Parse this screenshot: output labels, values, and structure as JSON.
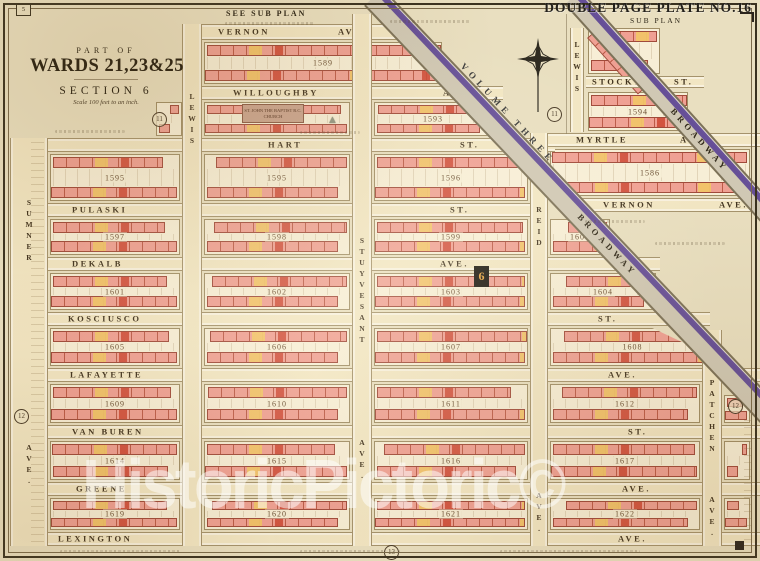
{
  "page": {
    "plate_label": "DOUBLE PAGE PLATE NO.16",
    "see_sub_plan": "SEE SUB PLAN",
    "sub_plan": "SUB PLAN",
    "volume_label": "VOLUME THREE",
    "watermark": "HistoricPictoric©",
    "corner_mark": "5",
    "section_marker": "6",
    "church_label": "ST. JOHN THE BAPTIST R.C. CHURCH",
    "triangle_symbol": "▲"
  },
  "title": {
    "part_of": "PART OF",
    "wards": "WARDS 21,23&25",
    "section": "SECTION 6",
    "scale": "Scale 100 feet to an inch."
  },
  "colors": {
    "paper": "#e9dfc0",
    "block_fill": "#f7eed6",
    "building_pink": "#efa093",
    "building_red": "#cd4632",
    "building_yellow": "#f2c468",
    "street_fill": "#f2e6c3",
    "broadway_purple": "#5a4194",
    "ink": "#41331f"
  },
  "streets": {
    "horizontal": [
      {
        "name": "vernon-ave-west",
        "x": 188,
        "y": 24,
        "w": 230,
        "h": 16,
        "labels": [
          {
            "t": "VERNON",
            "x": 30
          },
          {
            "t": "AVE.",
            "x": 150
          }
        ]
      },
      {
        "name": "willoughby-ave",
        "x": 185,
        "y": 86,
        "w": 318,
        "h": 14,
        "labels": [
          {
            "t": "WILLOUGHBY",
            "x": 48
          },
          {
            "t": "AVE.",
            "x": 258
          }
        ]
      },
      {
        "name": "hart-st",
        "x": 10,
        "y": 138,
        "w": 545,
        "h": 14,
        "labels": [
          {
            "t": "HART",
            "x": 258
          },
          {
            "t": "ST.",
            "x": 450
          }
        ]
      },
      {
        "name": "pulaski-st",
        "x": 10,
        "y": 203,
        "w": 522,
        "h": 14,
        "labels": [
          {
            "t": "PULASKI",
            "x": 62
          },
          {
            "t": "ST.",
            "x": 440
          }
        ]
      },
      {
        "name": "dekalb-ave",
        "x": 10,
        "y": 257,
        "w": 650,
        "h": 14,
        "labels": [
          {
            "t": "DEKALB",
            "x": 62
          },
          {
            "t": "AVE.",
            "x": 430
          }
        ]
      },
      {
        "name": "kosciusco-st",
        "x": 10,
        "y": 312,
        "w": 700,
        "h": 14,
        "labels": [
          {
            "t": "KOSCIUSCO",
            "x": 58
          },
          {
            "t": "ST.",
            "x": 588
          }
        ]
      },
      {
        "name": "lafayette-ave",
        "x": 10,
        "y": 368,
        "w": 750,
        "h": 14,
        "labels": [
          {
            "t": "LAFAYETTE",
            "x": 60
          },
          {
            "t": "AVE.",
            "x": 598
          }
        ]
      },
      {
        "name": "van-buren-st",
        "x": 10,
        "y": 425,
        "w": 750,
        "h": 14,
        "labels": [
          {
            "t": "VAN BUREN",
            "x": 62
          },
          {
            "t": "ST.",
            "x": 618
          }
        ]
      },
      {
        "name": "greene-ave",
        "x": 10,
        "y": 482,
        "w": 750,
        "h": 14,
        "labels": [
          {
            "t": "GREENE",
            "x": 66
          },
          {
            "t": "AVE.",
            "x": 612
          }
        ]
      },
      {
        "name": "lexington-ave",
        "x": 10,
        "y": 532,
        "w": 750,
        "h": 14,
        "labels": [
          {
            "t": "LEXINGTON",
            "x": 48
          },
          {
            "t": "AVE.",
            "x": 608
          }
        ]
      },
      {
        "name": "myrtle-ave",
        "x": 530,
        "y": 133,
        "w": 230,
        "h": 14,
        "labels": [
          {
            "t": "MYRTLE",
            "x": 46
          },
          {
            "t": "AVE.",
            "x": 150
          }
        ]
      },
      {
        "name": "vernon-ave-east",
        "x": 575,
        "y": 198,
        "w": 185,
        "h": 14,
        "labels": [
          {
            "t": "VERNON",
            "x": 28
          },
          {
            "t": "AVE.",
            "x": 144
          }
        ]
      },
      {
        "name": "stockton-st",
        "x": 586,
        "y": 76,
        "w": 118,
        "h": 12,
        "labels": [
          {
            "t": "STOCKTON",
            "x": 6
          },
          {
            "t": "ST.",
            "x": 88
          }
        ]
      }
    ],
    "vertical": [
      {
        "name": "sumner-ave",
        "x": 10,
        "y": 138,
        "w": 38,
        "h": 408,
        "labels": [
          {
            "t": "SUMNER",
            "y": 60
          },
          {
            "t": "AVE.",
            "y": 305
          }
        ]
      },
      {
        "name": "lewis-ave",
        "x": 182,
        "y": 24,
        "w": 20,
        "h": 522,
        "labels": [
          {
            "t": "LEWIS",
            "y": 68
          }
        ]
      },
      {
        "name": "stuyvesant-ave",
        "x": 352,
        "y": 14,
        "w": 20,
        "h": 532,
        "labels": [
          {
            "t": "STUYVESANT",
            "y": 222
          },
          {
            "t": "AVE.",
            "y": 424
          }
        ]
      },
      {
        "name": "reid-ave",
        "x": 530,
        "y": 133,
        "w": 18,
        "h": 413,
        "labels": [
          {
            "t": "REID",
            "y": 72
          },
          {
            "t": "AVE.",
            "y": 358
          }
        ]
      },
      {
        "name": "patchen-ave",
        "x": 702,
        "y": 330,
        "w": 20,
        "h": 216,
        "labels": [
          {
            "t": "PATCHEN",
            "y": 48
          },
          {
            "t": "AVE.",
            "y": 165
          }
        ]
      },
      {
        "name": "lewis-ave-subplan",
        "x": 570,
        "y": 28,
        "w": 14,
        "h": 104,
        "labels": [
          {
            "t": "LEWIS",
            "y": 12
          }
        ]
      }
    ],
    "diagonal": [
      {
        "name": "broadway-main",
        "x": 383,
        "y": -12,
        "len": 585,
        "wd": 26,
        "angle": 46.5,
        "label": "BROADWAY",
        "labelAt": 300
      },
      {
        "name": "broadway-subplan",
        "x": 581,
        "y": -10,
        "len": 300,
        "wd": 22,
        "angle": 48,
        "label": "BROADWAY",
        "labelAt": 150
      }
    ]
  },
  "blocks": [
    {
      "num": "1589",
      "x": 204,
      "y": 42,
      "w": 238,
      "h": 42
    },
    {
      "num": "",
      "x": 156,
      "y": 102,
      "w": 26,
      "h": 34
    },
    {
      "num": "1592",
      "x": 204,
      "y": 102,
      "w": 146,
      "h": 34
    },
    {
      "num": "1593",
      "x": 374,
      "y": 102,
      "w": 118,
      "h": 34
    },
    {
      "num": "1595",
      "x": 50,
      "y": 154,
      "w": 130,
      "h": 47
    },
    {
      "num": "1595",
      "x": 204,
      "y": 154,
      "w": 146,
      "h": 47
    },
    {
      "num": "1596",
      "x": 374,
      "y": 154,
      "w": 154,
      "h": 47
    },
    {
      "num": "1586",
      "x": 550,
      "y": 149,
      "w": 200,
      "h": 47
    },
    {
      "num": "1597",
      "x": 50,
      "y": 219,
      "w": 130,
      "h": 36
    },
    {
      "num": "1598",
      "x": 204,
      "y": 219,
      "w": 146,
      "h": 36
    },
    {
      "num": "1599",
      "x": 374,
      "y": 219,
      "w": 154,
      "h": 36
    },
    {
      "num": "1600",
      "x": 550,
      "y": 219,
      "w": 60,
      "h": 36
    },
    {
      "num": "1601",
      "x": 50,
      "y": 273,
      "w": 130,
      "h": 37
    },
    {
      "num": "1602",
      "x": 204,
      "y": 273,
      "w": 146,
      "h": 37
    },
    {
      "num": "1603",
      "x": 374,
      "y": 273,
      "w": 154,
      "h": 37
    },
    {
      "num": "1604",
      "x": 550,
      "y": 273,
      "w": 106,
      "h": 37
    },
    {
      "num": "1605",
      "x": 50,
      "y": 328,
      "w": 130,
      "h": 38
    },
    {
      "num": "1606",
      "x": 204,
      "y": 328,
      "w": 146,
      "h": 38
    },
    {
      "num": "1607",
      "x": 374,
      "y": 328,
      "w": 154,
      "h": 38
    },
    {
      "num": "1608",
      "x": 550,
      "y": 328,
      "w": 165,
      "h": 38,
      "clip": "polygon(0% 0%, 62% 0%, 100% 78%, 100% 100%, 0% 100%)"
    },
    {
      "num": "1609",
      "x": 50,
      "y": 384,
      "w": 130,
      "h": 39
    },
    {
      "num": "1610",
      "x": 204,
      "y": 384,
      "w": 146,
      "h": 39
    },
    {
      "num": "1611",
      "x": 374,
      "y": 384,
      "w": 154,
      "h": 39
    },
    {
      "num": "1612",
      "x": 550,
      "y": 384,
      "w": 150,
      "h": 39
    },
    {
      "num": "",
      "x": 724,
      "y": 395,
      "w": 26,
      "h": 28
    },
    {
      "num": "1614",
      "x": 50,
      "y": 441,
      "w": 130,
      "h": 39
    },
    {
      "num": "1615",
      "x": 204,
      "y": 441,
      "w": 146,
      "h": 39
    },
    {
      "num": "1616",
      "x": 374,
      "y": 441,
      "w": 154,
      "h": 39
    },
    {
      "num": "1617",
      "x": 550,
      "y": 441,
      "w": 150,
      "h": 39
    },
    {
      "num": "",
      "x": 724,
      "y": 441,
      "w": 26,
      "h": 39
    },
    {
      "num": "1619",
      "x": 50,
      "y": 498,
      "w": 130,
      "h": 32
    },
    {
      "num": "1620",
      "x": 204,
      "y": 498,
      "w": 146,
      "h": 32
    },
    {
      "num": "1621",
      "x": 374,
      "y": 498,
      "w": 154,
      "h": 32
    },
    {
      "num": "1622",
      "x": 550,
      "y": 498,
      "w": 150,
      "h": 32
    },
    {
      "num": "",
      "x": 724,
      "y": 498,
      "w": 26,
      "h": 32
    },
    {
      "num": "",
      "x": 588,
      "y": 28,
      "w": 72,
      "h": 46
    },
    {
      "num": "1594",
      "x": 588,
      "y": 92,
      "w": 100,
      "h": 39
    }
  ],
  "plate_refs": [
    {
      "label": "11",
      "x": 152,
      "y": 112
    },
    {
      "label": "11",
      "x": 547,
      "y": 107
    },
    {
      "label": "12",
      "x": 14,
      "y": 409
    },
    {
      "label": "12",
      "x": 728,
      "y": 399
    },
    {
      "label": "13",
      "x": 384,
      "y": 545
    }
  ]
}
